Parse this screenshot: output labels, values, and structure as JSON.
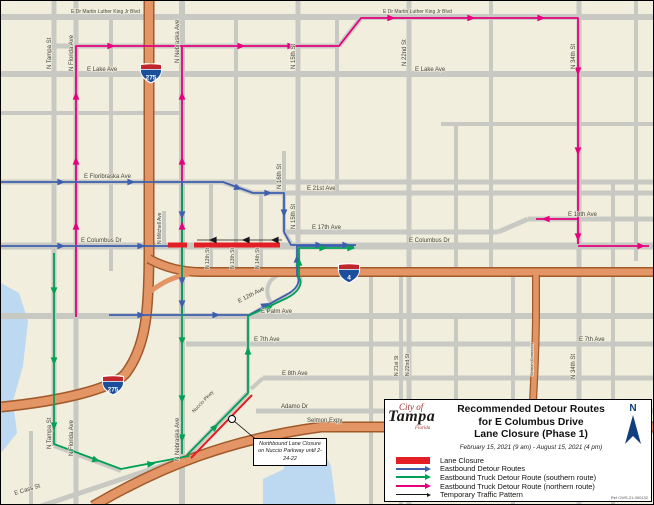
{
  "map": {
    "street_labels": [
      {
        "text": "E Dr Martin Luther King Jr Blvd",
        "x": 70,
        "y": 12,
        "rot": 0,
        "cls": "sm"
      },
      {
        "text": "E Dr Martin Luther King Jr Blvd",
        "x": 382,
        "y": 12,
        "rot": 0,
        "cls": "sm"
      },
      {
        "text": "E Lake Ave",
        "x": 86,
        "y": 70,
        "rot": 0
      },
      {
        "text": "E Lake Ave",
        "x": 414,
        "y": 70,
        "rot": 0
      },
      {
        "text": "E Floribraska Ave",
        "x": 83,
        "y": 177,
        "rot": 0
      },
      {
        "text": "E 21st Ave",
        "x": 306,
        "y": 189,
        "rot": 0
      },
      {
        "text": "E 17th Ave",
        "x": 311,
        "y": 228,
        "rot": 0
      },
      {
        "text": "E 18th Ave",
        "x": 567,
        "y": 215,
        "rot": 0
      },
      {
        "text": "E Columbus Dr",
        "x": 80,
        "y": 241,
        "rot": 0
      },
      {
        "text": "E Columbus Dr",
        "x": 408,
        "y": 241,
        "rot": 0
      },
      {
        "text": "E Palm Ave",
        "x": 260,
        "y": 312,
        "rot": 0
      },
      {
        "text": "E 12th Ave",
        "x": 238,
        "y": 302,
        "rot": -27
      },
      {
        "text": "E 7th Ave",
        "x": 253,
        "y": 340,
        "rot": 0
      },
      {
        "text": "E 7th Ave",
        "x": 578,
        "y": 340,
        "rot": 0
      },
      {
        "text": "E 8th Ave",
        "x": 281,
        "y": 374,
        "rot": 0
      },
      {
        "text": "Adamo Dr",
        "x": 280,
        "y": 407,
        "rot": 0
      },
      {
        "text": "Selmon Expy",
        "x": 306,
        "y": 421,
        "rot": 0
      },
      {
        "text": "E Cass St",
        "x": 14,
        "y": 494,
        "rot": -17
      },
      {
        "text": "Nuccio Pkwy",
        "x": 193,
        "y": 412,
        "rot": -46,
        "cls": "sm"
      },
      {
        "text": "N Tampa St",
        "x": 50,
        "y": 68,
        "rot": -90
      },
      {
        "text": "N Tampa St",
        "x": 50,
        "y": 448,
        "rot": -90
      },
      {
        "text": "N Florida Ave",
        "x": 72,
        "y": 70,
        "rot": -90
      },
      {
        "text": "N Florida Ave",
        "x": 72,
        "y": 455,
        "rot": -90
      },
      {
        "text": "N Nebraska Ave",
        "x": 178,
        "y": 62,
        "rot": -90
      },
      {
        "text": "N Nebraska Ave",
        "x": 178,
        "y": 460,
        "rot": -90
      },
      {
        "text": "N Mitchell Ave",
        "x": 160,
        "y": 243,
        "rot": -90,
        "cls": "sm"
      },
      {
        "text": "N 15th St",
        "x": 294,
        "y": 68,
        "rot": -90
      },
      {
        "text": "N 15th St",
        "x": 294,
        "y": 228,
        "rot": -90
      },
      {
        "text": "N 16th St",
        "x": 280,
        "y": 188,
        "rot": -90
      },
      {
        "text": "N 12th St",
        "x": 208,
        "y": 268,
        "rot": -90,
        "cls": "sm"
      },
      {
        "text": "N 13th St",
        "x": 233,
        "y": 268,
        "rot": -90,
        "cls": "sm"
      },
      {
        "text": "N 14th St",
        "x": 258,
        "y": 268,
        "rot": -90,
        "cls": "sm"
      },
      {
        "text": "N 21st St",
        "x": 397,
        "y": 375,
        "rot": -90,
        "cls": "sm"
      },
      {
        "text": "N 22nd St",
        "x": 405,
        "y": 65,
        "rot": -90
      },
      {
        "text": "N 22nd St",
        "x": 408,
        "y": 375,
        "rot": -90,
        "cls": "sm"
      },
      {
        "text": "N 34th St",
        "x": 574,
        "y": 68,
        "rot": -90
      },
      {
        "text": "N 34th St",
        "x": 574,
        "y": 378,
        "rot": -90
      },
      {
        "text": "Selmon Connector",
        "x": 532,
        "y": 375,
        "rot": -90,
        "cls": "xs"
      }
    ],
    "highway_shields": [
      {
        "number": "275",
        "x": 150,
        "y": 72
      },
      {
        "number": "275",
        "x": 112,
        "y": 384
      },
      {
        "number": "4",
        "x": 348,
        "y": 272
      }
    ],
    "callout": {
      "text": "Northbound Lane Closure on Nuccio Parkway until 2-24-22"
    },
    "colors": {
      "land": "#f2eedd",
      "water": "#bdd9f1",
      "road": "#c9c9c4",
      "interstate_fill": "#e39566",
      "interstate_casing": "#a05a2a",
      "lane_closure": "#e31e24",
      "detour_blue": "#3d5fae",
      "truck_green": "#00a157",
      "truck_pink": "#e5007e",
      "temp_black": "#1a1a1a"
    }
  },
  "legend": {
    "title_line1": "Recommended Detour Routes",
    "title_line2": "for E Columbus Drive",
    "title_line3": "Lane Closure (Phase 1)",
    "date_range": "February 15, 2021 (9 am) - August 15, 2021 (4 pm)",
    "items": [
      {
        "key": "lane-closure",
        "label": "Lane Closure",
        "color": "#e31e24"
      },
      {
        "key": "eastbound-detour",
        "label": "Eastbound Detour Routes",
        "color": "#3d5fae"
      },
      {
        "key": "truck-southern",
        "label": "Eastbound Truck Detour Route (southern route)",
        "color": "#00a157"
      },
      {
        "key": "truck-northern",
        "label": "Eastbound Truck Detour Route (northern route)",
        "color": "#e5007e"
      },
      {
        "key": "temporary-pattern",
        "label": "Temporary Traffic Pattern",
        "color": "#1a1a1a"
      }
    ],
    "logo": {
      "line1": "City of",
      "line2": "Tampa",
      "line3": "Florida"
    },
    "north_label": "N",
    "ref_number": "Ref CWS-21-000132"
  }
}
